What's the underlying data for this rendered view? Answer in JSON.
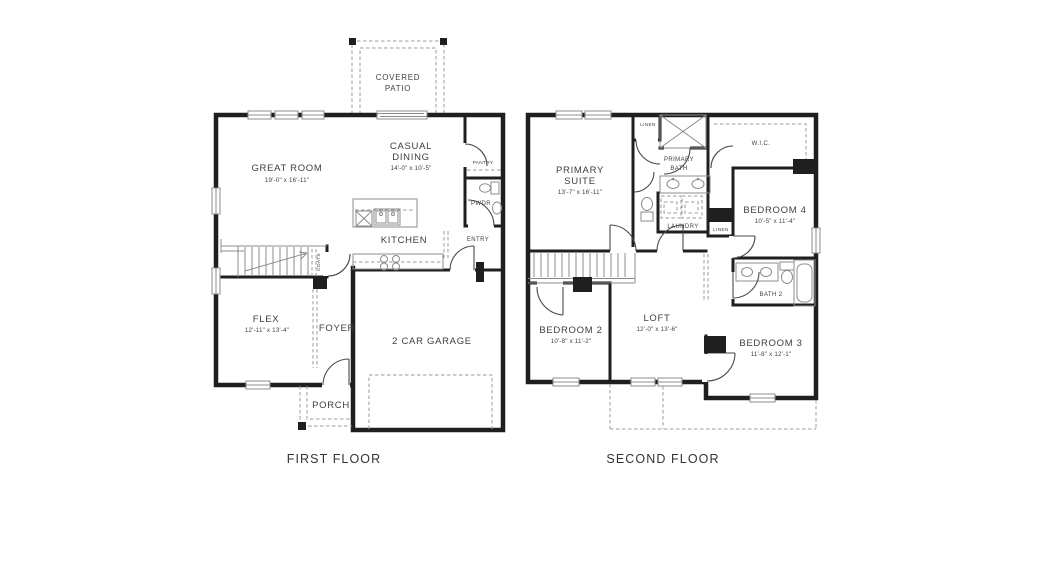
{
  "colors": {
    "background": "#ffffff",
    "walls": "#1f1f1f",
    "detail_gray": "#8c8c8c",
    "dashed_gray": "#9b9b9b",
    "text": "#3f3f3f"
  },
  "first_floor": {
    "title": "FIRST FLOOR",
    "covered_patio_line1": "COVERED",
    "covered_patio_line2": "PATIO",
    "great_room": "GREAT ROOM",
    "great_room_dims": "19'-0\" x 16'-11\"",
    "casual_dining_line1": "CASUAL",
    "casual_dining_line2": "DINING",
    "casual_dining_dims": "14'-0\" x 10'-5\"",
    "pantry": "PANTRY",
    "pwdr": "PWDR",
    "entry": "ENTRY",
    "kitchen": "KITCHEN",
    "coats": "COATS",
    "flex": "FLEX",
    "flex_dims": "12'-11\" x 13'-4\"",
    "foyer": "FOYER",
    "garage": "2 CAR GARAGE",
    "porch": "PORCH"
  },
  "second_floor": {
    "title": "SECOND FLOOR",
    "primary_suite_line1": "PRIMARY",
    "primary_suite_line2": "SUITE",
    "primary_suite_dims": "13'-7\" x 16'-11\"",
    "linen_top": "LINEN",
    "primary_bath_line1": "PRIMARY",
    "primary_bath_line2": "BATH",
    "wic": "W.I.C.",
    "laundry": "LAUNDRY",
    "bedroom4": "BEDROOM 4",
    "bedroom4_dims": "10'-5\" x 11'-4\"",
    "linen_hall": "LINEN",
    "bedroom2": "BEDROOM 2",
    "bedroom2_dims": "10'-8\" x 11'-2\"",
    "loft": "LOFT",
    "loft_dims": "12'-0\" x 13'-6\"",
    "bath2": "BATH 2",
    "bedroom3": "BEDROOM 3",
    "bedroom3_dims": "11'-8\" x 12'-1\""
  }
}
